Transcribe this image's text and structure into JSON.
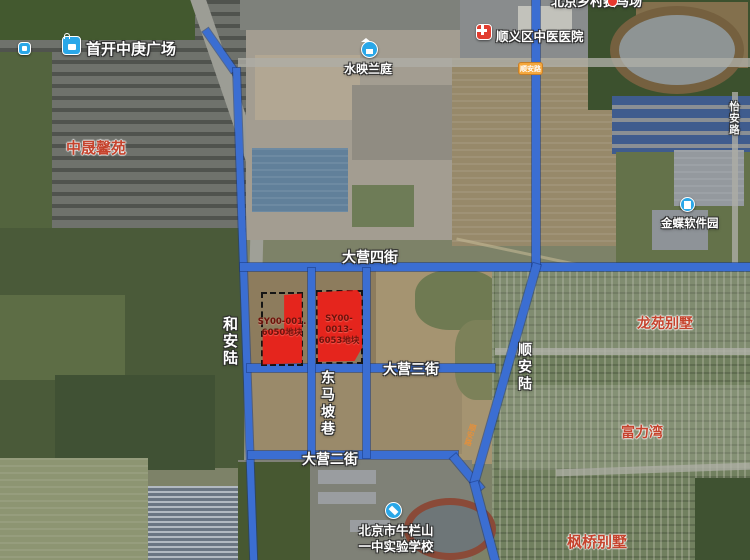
{
  "roads": {
    "daying4": "大营四街",
    "daying3": "大营三街",
    "daying2": "大营二街",
    "dongmapo": "东马坡巷",
    "heanlu": "和安陆",
    "shunanlu": "顺安陆",
    "yianlu": "怡安路",
    "shunan_small": "顺安路",
    "badge": "顺安路"
  },
  "pois": {
    "shoukai": {
      "label": "首开中庚广场",
      "icon": "shopping-bag"
    },
    "shuiying": {
      "label": "水映兰庭",
      "icon": "residence"
    },
    "hospital": {
      "label": "顺义区中医医院",
      "icon": "hospital-cross"
    },
    "kingdee": {
      "label": "金蝶软件园",
      "icon": "office-building"
    },
    "school": {
      "line1": "北京市牛栏山",
      "line2": "一中实验学校",
      "icon": "school-cap"
    },
    "racecourse": {
      "label": "北京乡村赛马场",
      "icon": "location-pin"
    }
  },
  "residential": {
    "zhongsheng": "中晟馨苑",
    "longyuan": "龙苑别墅",
    "fuliwan": "富力湾",
    "fengqiao": "枫桥别墅"
  },
  "parcels": [
    {
      "line1": "SY00-001.",
      "line2": "6050地块"
    },
    {
      "line1": "SY00-0013-",
      "line2": "6053地块"
    }
  ],
  "colors": {
    "road_blue": "#3b6ed2",
    "parcel_red": "#ee1c16",
    "residential_red": "#c5432d",
    "parcel_label_red": "#6d120b",
    "poi_blue": "#2aa7e8",
    "hospital_red": "#e23d30",
    "badge_orange": "#f5a83d",
    "pin_red": "#e8392f"
  }
}
